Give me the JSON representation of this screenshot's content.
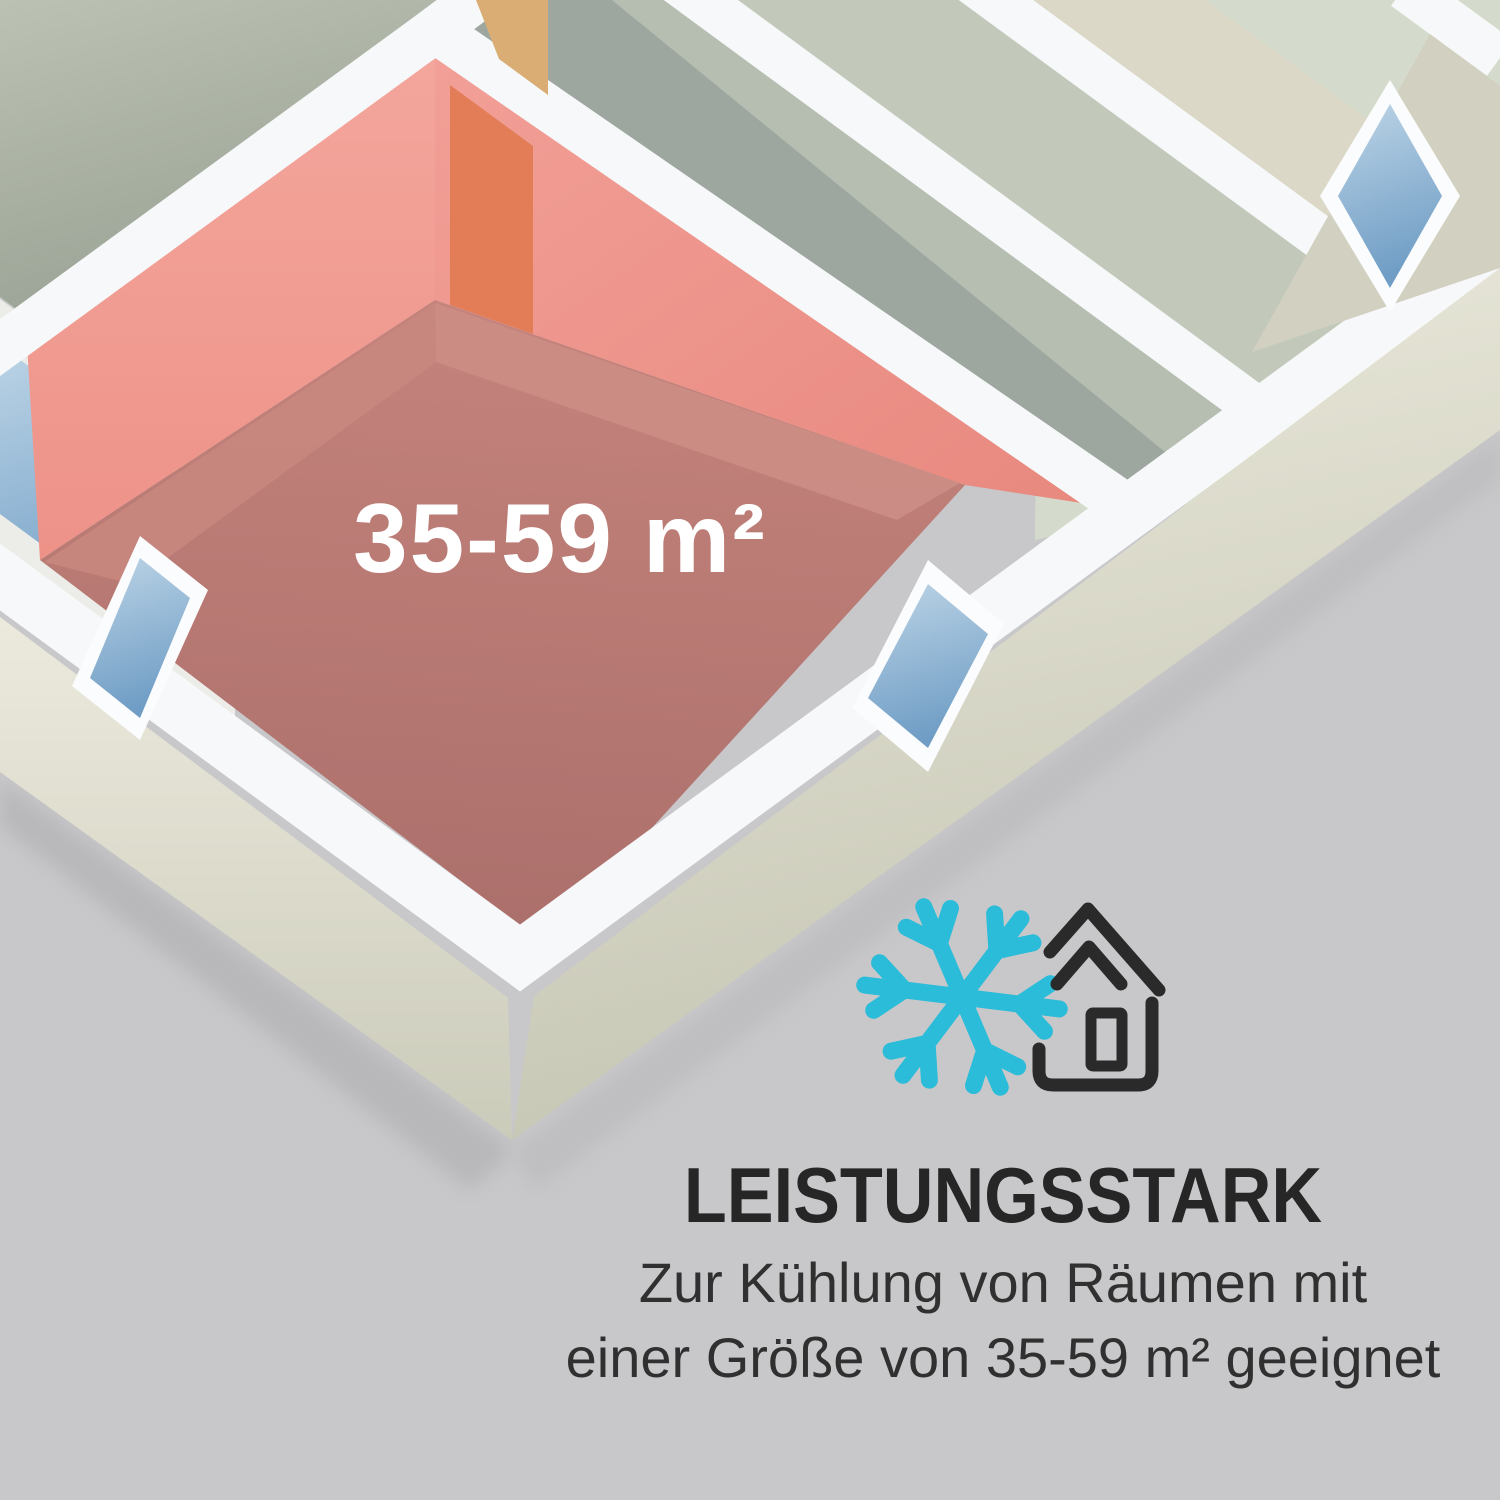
{
  "floor_plan": {
    "room_label": "35-59 m²",
    "highlighted_room_wall_color": "#f09a90",
    "highlighted_room_floor_color": "#b4766f",
    "door_color": "#e27d57",
    "wall_top_color": "#f6f8f9",
    "exterior_wall_color": "#e9e8da",
    "other_room_floor_colors": [
      "#9da79f",
      "#b5beb1",
      "#c2c9bb",
      "#d5dbcc"
    ],
    "window_glass_color": "#7da3c6",
    "background_color": "#c8c8ca"
  },
  "feature_section": {
    "icons": [
      {
        "name": "snowflake-icon",
        "color": "#2bbcd9"
      },
      {
        "name": "house-outline-icon",
        "color": "#2a2a2a"
      }
    ],
    "heading": "LEISTUNGSSTARK",
    "body_line1": "Zur Kühlung von Räumen mit",
    "body_line2": "einer Größe von 35-59 m² geeignet",
    "heading_color": "#262626",
    "body_color": "#303030"
  }
}
